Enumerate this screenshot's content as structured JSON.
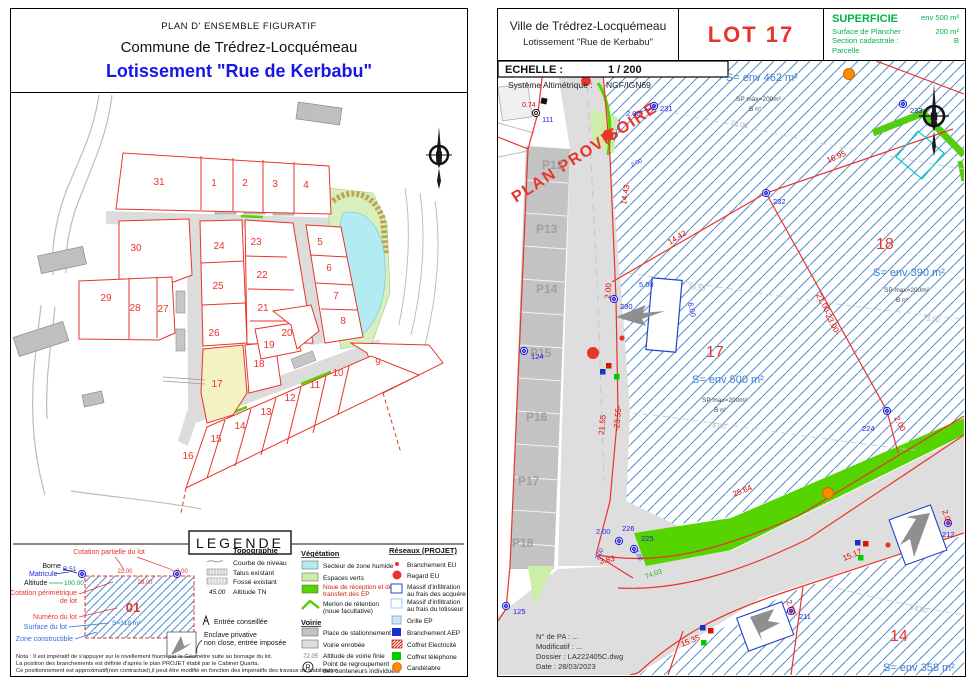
{
  "north_letter": "N",
  "left_panel": {
    "header": {
      "title_small": "PLAN D' ENSEMBLE FIGURATIF",
      "commune": "Commune de Trédrez-Locquémeau",
      "lotissement": "Lotissement \"Rue de Kerbabu\""
    },
    "map": {
      "lots": [
        "31",
        "1",
        "2",
        "3",
        "4",
        "30",
        "24",
        "23",
        "5",
        "22",
        "25",
        "6",
        "29",
        "28",
        "27",
        "21",
        "7",
        "26",
        "20",
        "8",
        "19",
        "18",
        "9",
        "17",
        "10",
        "11",
        "12",
        "13",
        "14",
        "15",
        "16"
      ]
    },
    "legend": {
      "title": "LEGENDE",
      "sample": {
        "borne": "Borne",
        "matricule": "Matricule",
        "matricule_value": "B.51",
        "altitude": "Altitude",
        "altitude_value": "100.00",
        "cotation_partielle": "Cotation partielle du lot",
        "cotation_perimetrique_1": "Cotation périmétrique",
        "cotation_perimetrique_2": "de lot",
        "numero": "Numéro du lot",
        "numero_value": "01",
        "surface": "Surface du lot",
        "surface_value": "S=318 m²",
        "zone": "Zone constructible",
        "dim_top1": "22.00",
        "dim_top2": "3.00",
        "dim_inner": "28.00",
        "entree": "Entrée conseillée",
        "enclave_1": "Enclave privative",
        "enclave_2": "non close, entrée imposée"
      },
      "topographie": {
        "title": "Topographie",
        "courbe": "Courbe de niveau",
        "talus": "Talus existant",
        "fosse": "Fossé existant",
        "altitude_tn_value": "45.00",
        "altitude_tn": "Altitude TN"
      },
      "vegetation": {
        "title": "Végétation",
        "zone_humide": "Secteur de zone humide",
        "espaces_verts": "Espaces verts",
        "noue_1": "Noue de réception et de",
        "noue_2": "transfert des EP",
        "merlon_1": "Merlon de rétention",
        "merlon_2": "(noue facultative)"
      },
      "voirie": {
        "title": "Voirie",
        "stationnement": "Place de stationnement",
        "enrobee": "Voirie enrobée",
        "altitude_voirie": "Altitude de voirie finie",
        "altitude_voirie_value": "72.05",
        "r_symbol": "R",
        "regroupement_1": "Point de regroupement",
        "regroupement_2": "des conteneurs individuels"
      },
      "reseaux": {
        "title": "Réseaux (PROJET)",
        "branchement_eu": "Branchement EU",
        "regard_eu": "Regard EU",
        "massif_acq_1": "Massif d'infiltration",
        "massif_acq_2": "au frais des acquéreurs",
        "massif_lot_1": "Massif d'infiltration",
        "massif_lot_2": "au frais du lotisseur",
        "grille_ep": "Grille EP",
        "branchement_aep": "Branchement AEP",
        "coffret_elec": "Coffret Electricité",
        "coffret_tel": "Coffret téléphone",
        "candelabre": "Candélabre"
      },
      "nota_1": "Nota : Il est impératif de s'appuyer sur le nivellement fourni par le Géomètre suite au bornage du lot.",
      "nota_2": "La position des branchements est définie d'après le plan PROJET établi par le Cabinet Quarta.",
      "nota_3": "Ce positionnement est approximatif(non contractuel),il peut être modifié en fonction des impératifs des travaux de viabilisation ."
    }
  },
  "right_panel": {
    "header": {
      "city": "Ville de Trédrez-Locquémeau",
      "lotissement": "Lotissement \"Rue de Kerbabu\"",
      "lot_title": "LOT 17",
      "superficie_label": "SUPERFICIE",
      "superficie_value": "env 500 m²",
      "plancher_label": "Surface de Plancher :",
      "plancher_value": "200 m²",
      "section_label": "Section cadastrale :",
      "section_value": "B",
      "parcelle": "Parcelle"
    },
    "scale_label": "ECHELLE :",
    "scale_value": "1 / 200",
    "alti_label": "Système Altimétrique :",
    "alti_value": "NGF/IGN69",
    "watermark": "PLAN PROVISOIRE",
    "map": {
      "parkings": [
        "P12",
        "P13",
        "P14",
        "P15",
        "P16",
        "P17",
        "P18"
      ],
      "lot17": "17",
      "lot18": "18",
      "lot14": "14",
      "s462": "S= env 462 m²",
      "s390": "S= env 390 m²",
      "s500": "S= env 500 m²",
      "s358": "S= env 358 m²",
      "sp_max": "SP max=200m²",
      "b_no": "B n°",
      "m231": "231",
      "m232": "232",
      "m233": "233",
      "m230": "230",
      "m224": "224",
      "m226": "226",
      "m225": "225",
      "m124": "124",
      "m125": "125",
      "m211": "211",
      "m212": "212",
      "m111": "111",
      "d_1443": "14.43",
      "d_1695": "16.95",
      "d_1442": "14.42",
      "d_2100": "21.00",
      "d_2300": "-23.00-",
      "d_2155": "21.55",
      "d_2355": "-23.55-",
      "d_2564": "25.64",
      "d_1535": "15.35",
      "d_1517": "15.17",
      "d_383": "3.83",
      "d_074": "0.74",
      "d_200": "2.00",
      "d_500": "5.00",
      "d_600": "6.00",
      "c_7300": "73.00",
      "c_7350": "73.50",
      "c_7400": "74.00",
      "c_7450": "74.50",
      "c_7403": "74.03"
    },
    "titleblock": {
      "line1": "N° de PA : ...",
      "line2": "Modificatif : ...",
      "line3": "Dossier : LA222405C.dwg",
      "line4": "Date : 28/03/2023"
    }
  }
}
